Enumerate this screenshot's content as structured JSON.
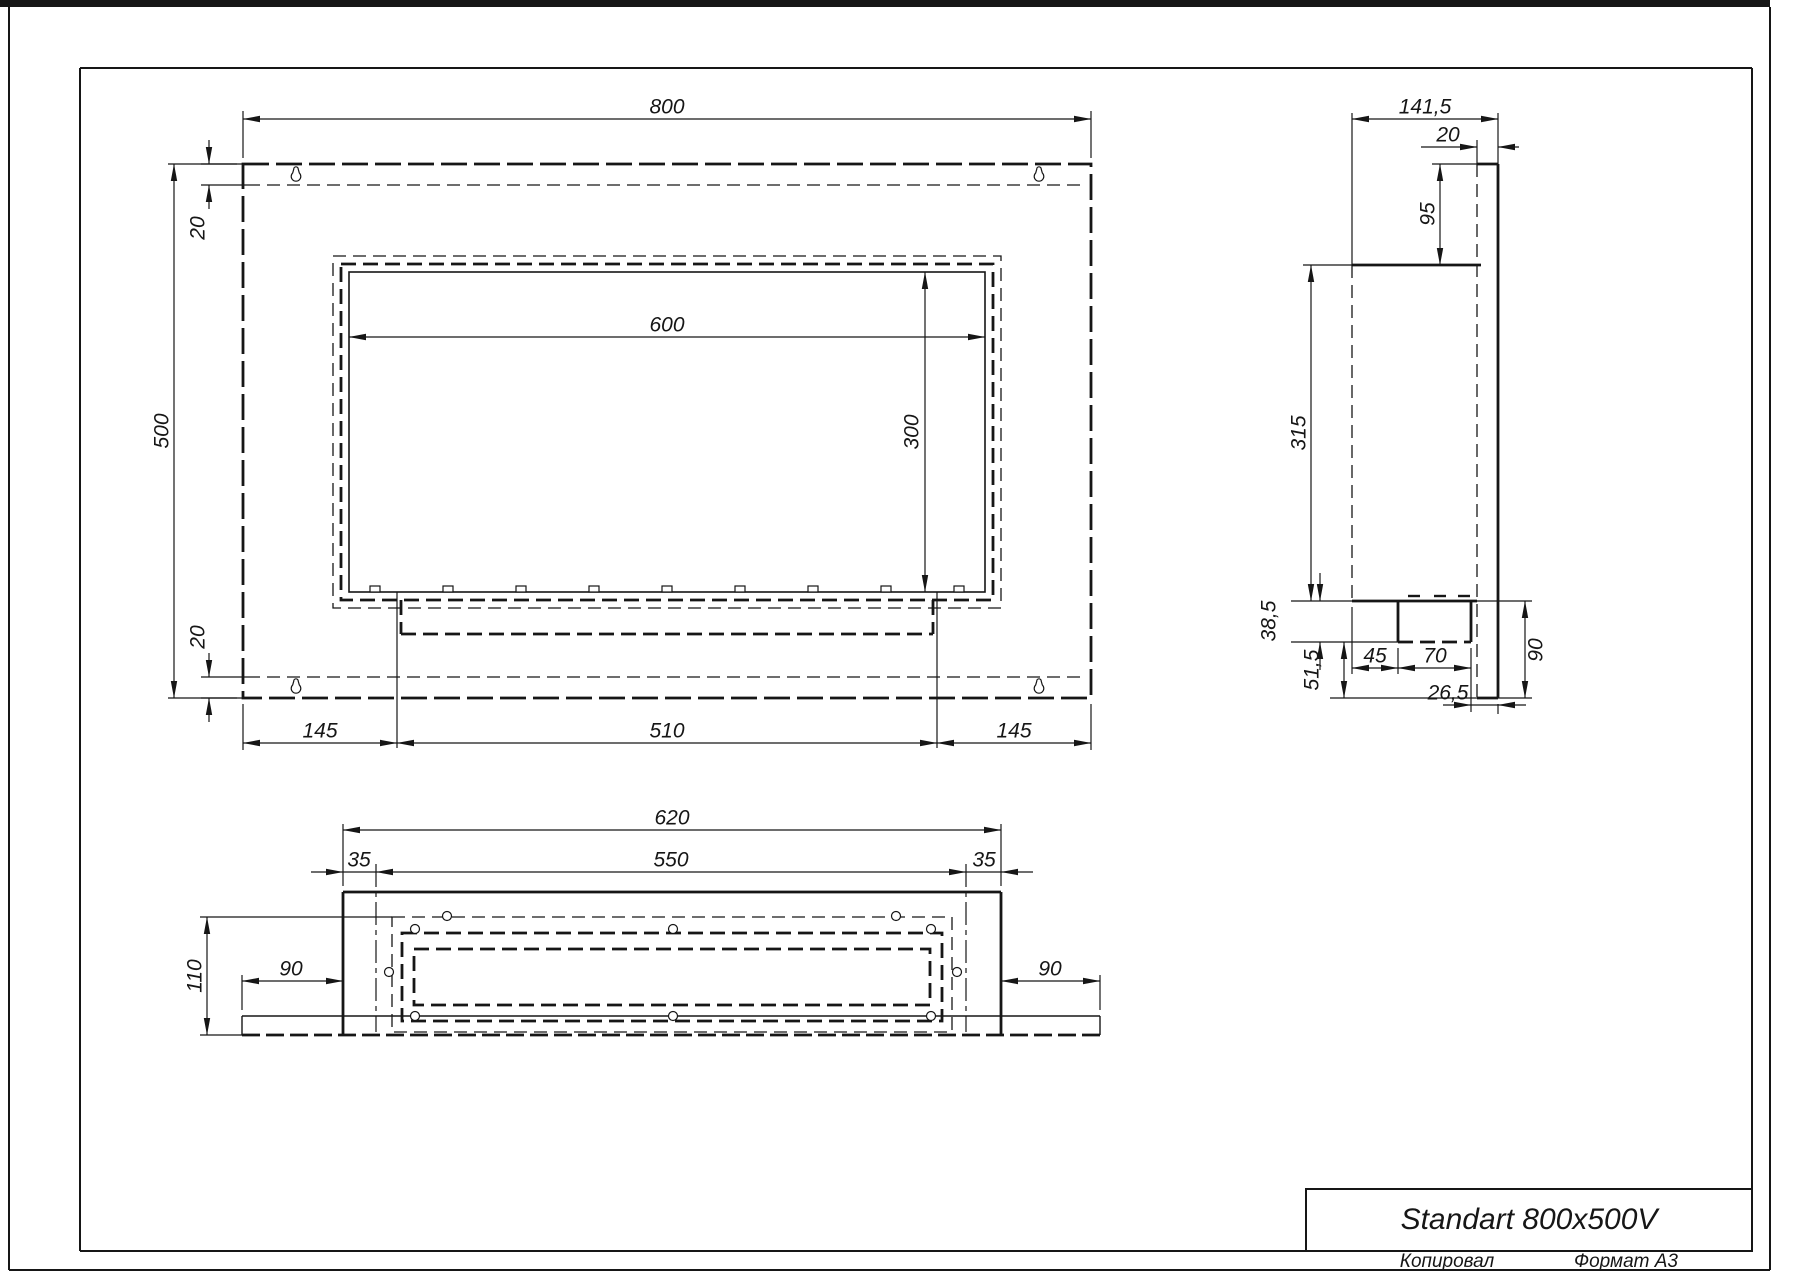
{
  "sheet": {
    "title": "Standart 800x500V",
    "footer": {
      "copied_by_label": "Копировал",
      "format_label": "Формат А3"
    }
  },
  "front_view": {
    "width": "800",
    "height": "500",
    "top_inset": "20",
    "bottom_inset": "20",
    "opening_width": "600",
    "opening_height": "300",
    "left_margin": "145",
    "burner_slot_width": "510",
    "right_margin": "145"
  },
  "side_view": {
    "total_depth": "141,5",
    "back_panel_thickness": "20",
    "panel_top_to_body": "95",
    "body_height": "315",
    "tray_drop": "38,5",
    "below_tray": "51,5",
    "front_to_tray": "45",
    "tray_depth": "70",
    "tray_to_back": "26,5",
    "panel_below_body": "90"
  },
  "bottom_view": {
    "body_width": "620",
    "opening_width": "550",
    "inset_left": "35",
    "inset_right": "35",
    "flange_left": "90",
    "flange_right": "90",
    "total_depth": "110"
  },
  "colors": {
    "line": "#161616",
    "background": "#ffffff"
  }
}
